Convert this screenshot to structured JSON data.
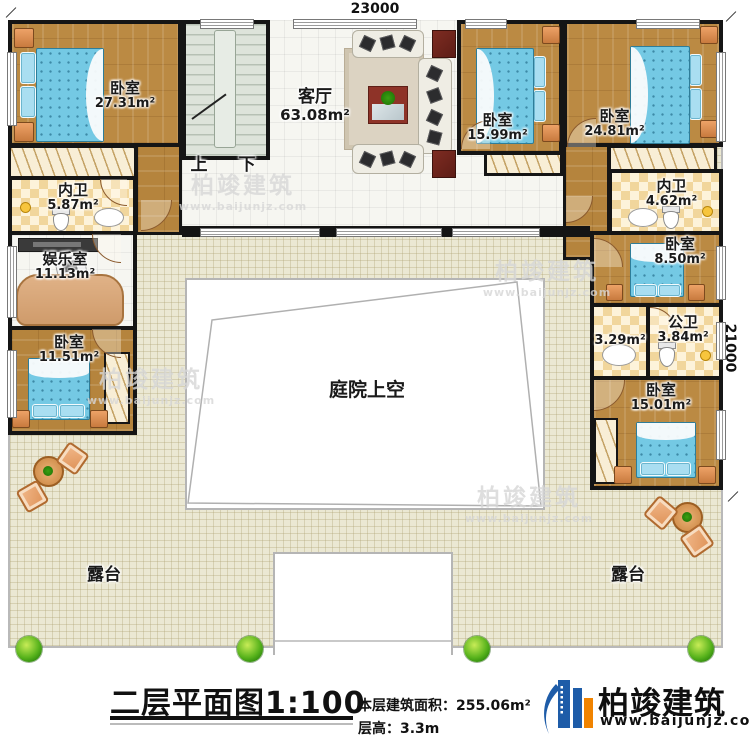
{
  "plan": {
    "dim_top": "23000",
    "dim_right": "21000",
    "courtyard_label": "庭院上空",
    "stairs_up": "上",
    "stairs_down": "下",
    "terrace_left": "露台",
    "terrace_right": "露台"
  },
  "rooms": {
    "bedroom_tl": {
      "name": "卧室",
      "area": "27.31m²"
    },
    "neiwei_top_left": {
      "name": "内卫",
      "area": "5.87m²"
    },
    "living": {
      "name": "客厅",
      "area": "63.08m²"
    },
    "bedroom_top_mid": {
      "name": "卧室",
      "area": "15.99m²"
    },
    "bedroom_top_right": {
      "name": "卧室",
      "area": "24.81m²"
    },
    "neiwei_top_right": {
      "name": "内卫",
      "area": "4.62m²"
    },
    "entertainment": {
      "name": "娱乐室",
      "area": "11.13m²"
    },
    "bedroom_left": {
      "name": "卧室",
      "area": "11.51m²"
    },
    "bedroom_right_small": {
      "name": "卧室",
      "area": "8.50m²"
    },
    "vanity": {
      "area": "3.29m²"
    },
    "public_bath": {
      "name": "公卫",
      "area": "3.84m²"
    },
    "bedroom_right_bottom": {
      "name": "卧室",
      "area": "15.01m²"
    }
  },
  "title_block": {
    "title": "二层平面图1:100",
    "floor_area_label": "本层建筑面积：",
    "floor_area_value": "255.06m²",
    "floor_height_label": "层高：",
    "floor_height_value": "3.3m"
  },
  "logo": {
    "name": "柏竣建筑",
    "url": "www.baijunjz.com"
  },
  "watermark": {
    "text": "柏竣建筑",
    "url": "www.baijunjz.com"
  },
  "colors": {
    "wall": "#151515",
    "wood": "#bb8a43",
    "terrace": "#ebe8d3",
    "logo_blue": "#1e5ca8",
    "logo_orange": "#f08300"
  }
}
